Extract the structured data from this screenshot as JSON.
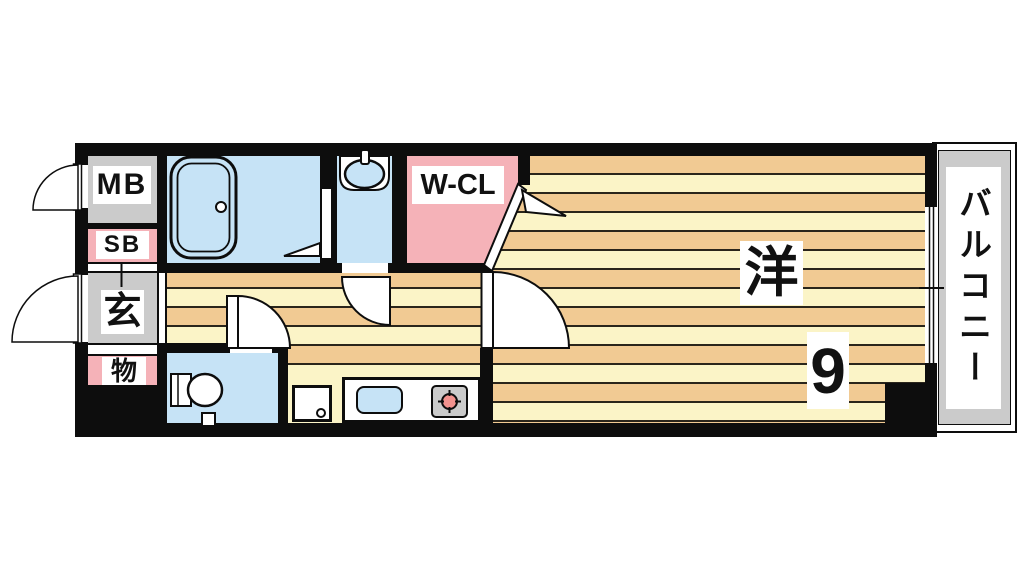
{
  "floorplan": {
    "title": "1K apartment floor plan",
    "rooms": {
      "meter_box": "MB",
      "shoe_box": "SB",
      "entrance": "玄",
      "storage": "物",
      "walk_in_closet": "W-CL",
      "western_room": "洋",
      "western_room_size": "9",
      "balcony": "バルコニー"
    },
    "colors": {
      "wall": "#0d0d0d",
      "line": "#2a251b",
      "floor_cream": "#FBF4C7",
      "floor_tan": "#F1CA93",
      "wet_blue": "#C6E3F6",
      "pink": "#F5B2B8",
      "gray": "#CBCBCB",
      "burner": "#F2928E"
    },
    "fixtures": [
      "bathtub",
      "wash-basin",
      "toilet",
      "kitchen-sink",
      "gas-stove",
      "washing-machine-pan",
      "sliding-window",
      "entrance-door",
      "meter-box-door",
      "toilet-door",
      "washroom-door",
      "main-room-door",
      "closet-door",
      "folding-bath-door"
    ]
  }
}
